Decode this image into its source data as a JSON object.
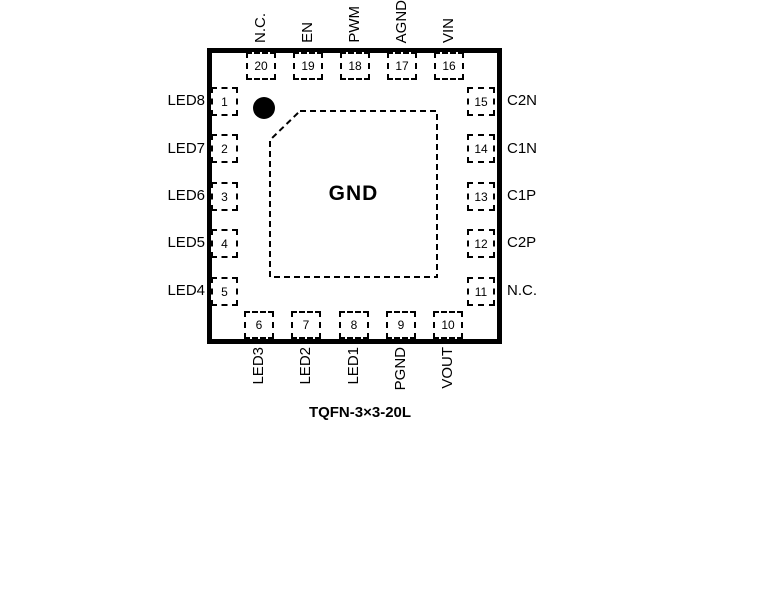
{
  "package": {
    "caption": "TQFN-3×3-20L",
    "center_pad_label": "GND"
  },
  "pins": {
    "top": [
      {
        "number": "20",
        "name": "N.C."
      },
      {
        "number": "19",
        "name": "EN"
      },
      {
        "number": "18",
        "name": "PWM"
      },
      {
        "number": "17",
        "name": "AGND"
      },
      {
        "number": "16",
        "name": "VIN"
      }
    ],
    "left": [
      {
        "number": "1",
        "name": "LED8"
      },
      {
        "number": "2",
        "name": "LED7"
      },
      {
        "number": "3",
        "name": "LED6"
      },
      {
        "number": "4",
        "name": "LED5"
      },
      {
        "number": "5",
        "name": "LED4"
      }
    ],
    "right": [
      {
        "number": "15",
        "name": "C2N"
      },
      {
        "number": "14",
        "name": "C1N"
      },
      {
        "number": "13",
        "name": "C1P"
      },
      {
        "number": "12",
        "name": "C2P"
      },
      {
        "number": "11",
        "name": "N.C."
      }
    ],
    "bottom": [
      {
        "number": "6",
        "name": "LED3"
      },
      {
        "number": "7",
        "name": "LED2"
      },
      {
        "number": "8",
        "name": "LED1"
      },
      {
        "number": "9",
        "name": "PGND"
      },
      {
        "number": "10",
        "name": "VOUT"
      }
    ]
  },
  "colors": {
    "line": "#000000",
    "background": "#ffffff"
  }
}
